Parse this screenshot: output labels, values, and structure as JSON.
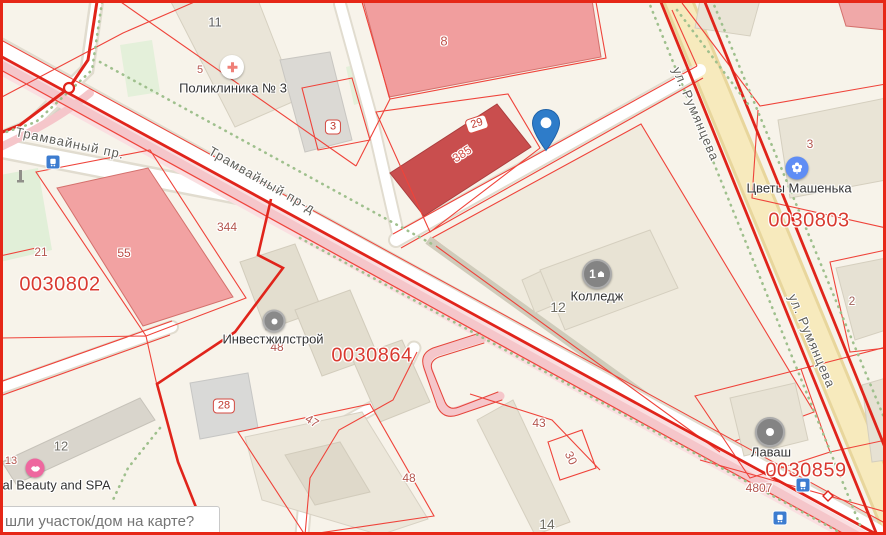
{
  "search": {
    "placeholder": "шли участок/дом на карте?"
  },
  "streets": {
    "tram_pr": "Трамвайный пр.",
    "tram_prd": "Трамвайный пр-д",
    "rum1": "ул. Румянцева",
    "rum2": "ул. Румянцева"
  },
  "poi": {
    "polyclinic": "Поликлиника № 3",
    "college": "Колледж",
    "invest": "Инвестжилстрой",
    "lavash": "Лаваш",
    "flowers": "Цветы Машенька",
    "beauty": "cal Beauty and SPA"
  },
  "quarters": {
    "q802": "0030802",
    "q864": "0030864",
    "q803": "0030803",
    "q859": "0030859"
  },
  "parcels": {
    "n5": "5",
    "n8": "8",
    "n21": "21",
    "n55": "55",
    "n344": "344",
    "n48a": "48",
    "n48b": "48",
    "n43": "43",
    "n47": "47",
    "n30": "30",
    "n13": "13",
    "n3": "3",
    "n4807": "4807",
    "n385": "385",
    "n2": "2"
  },
  "buildings": {
    "n11": "11",
    "n12_college": "12",
    "n12_left": "12",
    "n14": "14"
  },
  "pills": {
    "p3": "3",
    "p29": "29",
    "p28": "28"
  },
  "icons": {
    "college_badge": "1"
  },
  "colors": {
    "cadastral_red": "#e0241b",
    "parcel_red": "#b4564e",
    "quarter_red": "#d93a30",
    "road_yellow": "#f6e9bb",
    "tram_pink": "#f5c6ca",
    "pin_blue": "#2e7cc9",
    "poi_blue": "#5f8df5",
    "poi_pink": "#ee679f",
    "poi_gray": "#8a8a8a"
  }
}
